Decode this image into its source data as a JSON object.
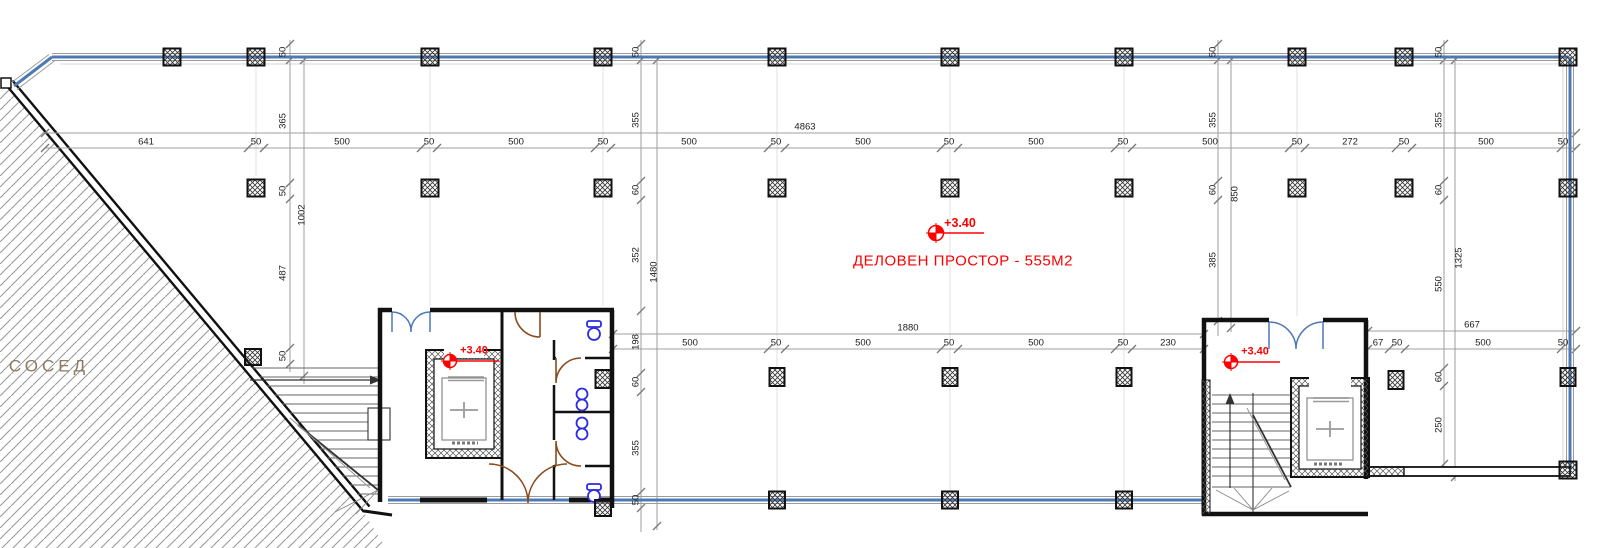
{
  "colors": {
    "wall_blue": "#4d79b5",
    "boundary_black": "#111111",
    "dim_line": "#999999",
    "dim_text": "#1c1c1c",
    "red": "#ff0000",
    "neighbor_text": "#8c7a60",
    "hatch_gray": "#9a9a9a",
    "door_brown": "#8a4a1d",
    "fixture_blue": "#2b2be0"
  },
  "plan": {
    "neighbor_label": "СОСЕД",
    "room_label": "ДЕЛОВЕН ПРОСТОР - 555М2",
    "level_marker": "+3.40"
  },
  "dims": {
    "top_total": "4863",
    "mid_total": "1880",
    "right_total": "667",
    "top": [
      "641",
      "50",
      "500",
      "50",
      "500",
      "50",
      "500",
      "50",
      "500",
      "50",
      "500",
      "50",
      "500",
      "50",
      "272",
      "50",
      "500",
      "50"
    ],
    "mid": [
      "500",
      "50",
      "500",
      "50",
      "500",
      "50",
      "230"
    ],
    "mid_right": [
      "67",
      "50",
      "500",
      "50"
    ],
    "v_left": [
      "50",
      "365",
      "50",
      "487",
      "50"
    ],
    "v_left_total": "1002",
    "v_mid": [
      "50",
      "355",
      "60",
      "352",
      "198",
      "60",
      "355",
      "50"
    ],
    "v_mid_total": "1480",
    "v_right_a": [
      "50",
      "355",
      "60",
      "385"
    ],
    "v_right_a_total": "850",
    "v_right_b": [
      "50",
      "355",
      "60",
      "550",
      "60",
      "250"
    ],
    "v_right_b_total": "1325"
  }
}
